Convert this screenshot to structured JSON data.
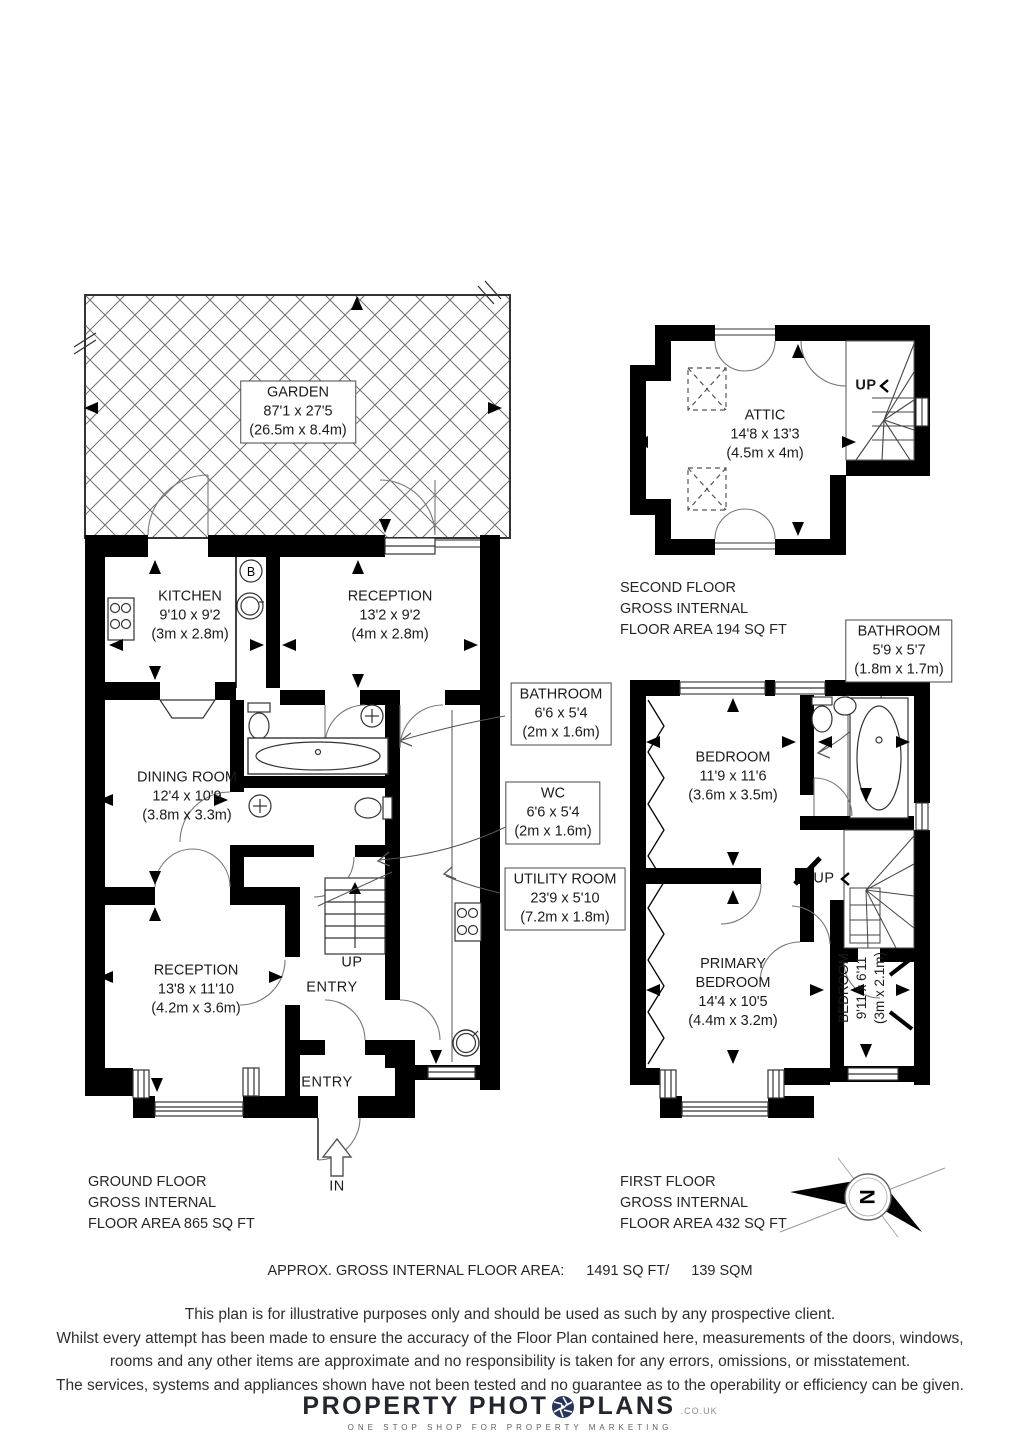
{
  "garden": {
    "name": "GARDEN",
    "imperial": "87'1 x 27'5",
    "metric": "(26.5m x 8.4m)"
  },
  "second_floor": {
    "attic": {
      "name": "ATTIC",
      "imperial": "14'8 x 13'3",
      "metric": "(4.5m x 4m)"
    },
    "up_label": "UP",
    "footer": {
      "line1": "SECOND FLOOR",
      "line2": "GROSS INTERNAL",
      "line3": "FLOOR AREA 194 SQ FT"
    }
  },
  "ground_floor": {
    "kitchen": {
      "name": "KITCHEN",
      "imperial": "9'10 x 9'2",
      "metric": "(3m x 2.8m)"
    },
    "reception_rear": {
      "name": "RECEPTION",
      "imperial": "13'2 x 9'2",
      "metric": "(4m x 2.8m)"
    },
    "dining_room": {
      "name": "DINING ROOM",
      "imperial": "12'4 x 10'9",
      "metric": "(3.8m x 3.3m)"
    },
    "reception_front": {
      "name": "RECEPTION",
      "imperial": "13'8 x 11'10",
      "metric": "(4.2m x 3.6m)"
    },
    "bathroom": {
      "name": "BATHROOM",
      "imperial": "6'6 x 5'4",
      "metric": "(2m x 1.6m)"
    },
    "wc": {
      "name": "WC",
      "imperial": "6'6 x 5'4",
      "metric": "(2m x 1.6m)"
    },
    "utility_room": {
      "name": "UTILITY ROOM",
      "imperial": "23'9 x 5'10",
      "metric": "(7.2m x 1.8m)"
    },
    "boiler_label": "B",
    "up_label": "UP",
    "entry_rear_label": "ENTRY",
    "entry_front_label": "ENTRY",
    "in_label": "IN",
    "footer": {
      "line1": "GROUND FLOOR",
      "line2": "GROSS INTERNAL",
      "line3": "FLOOR AREA 865 SQ FT"
    }
  },
  "first_floor": {
    "bathroom": {
      "name": "BATHROOM",
      "imperial": "5'9 x 5'7",
      "metric": "(1.8m x 1.7m)"
    },
    "bedroom_rear": {
      "name": "BEDROOM",
      "imperial": "11'9 x 11'6",
      "metric": "(3.6m x 3.5m)"
    },
    "primary_bedroom": {
      "name": "PRIMARY BEDROOM",
      "imperial": "14'4 x 10'5",
      "metric": "(4.4m x 3.2m)"
    },
    "bedroom_front": {
      "name": "BEDROOM",
      "imperial": "9'11 x 6'11",
      "metric": "(3m x 2.1m)"
    },
    "up_label": "UP",
    "compass_label": "N",
    "footer": {
      "line1": "FIRST FLOOR",
      "line2": "GROSS INTERNAL",
      "line3": "FLOOR AREA 432 SQ FT"
    }
  },
  "summary": {
    "label": "APPROX. GROSS INTERNAL FLOOR AREA:",
    "sqft": "1491 SQ FT/",
    "sqm": "139 SQM"
  },
  "disclaimer": {
    "line1": "This plan is for illustrative purposes only and should be used as such by any prospective client.",
    "line2": "Whilst every attempt has been made to ensure the accuracy of the Floor Plan contained here, measurements of the doors, windows,",
    "line3": "rooms and any other items are approximate and no responsibility is taken for any errors, omissions, or misstatement.",
    "line4": "The services, systems and appliances shown have not been tested and no guarantee as to the operability or efficiency can be given."
  },
  "logo": {
    "brand_left": "PROPERTY PHOT",
    "brand_right": "PLANS",
    "brand_suffix": ".CO.UK",
    "tagline": "ONE STOP SHOP FOR PROPERTY MARKETING"
  }
}
